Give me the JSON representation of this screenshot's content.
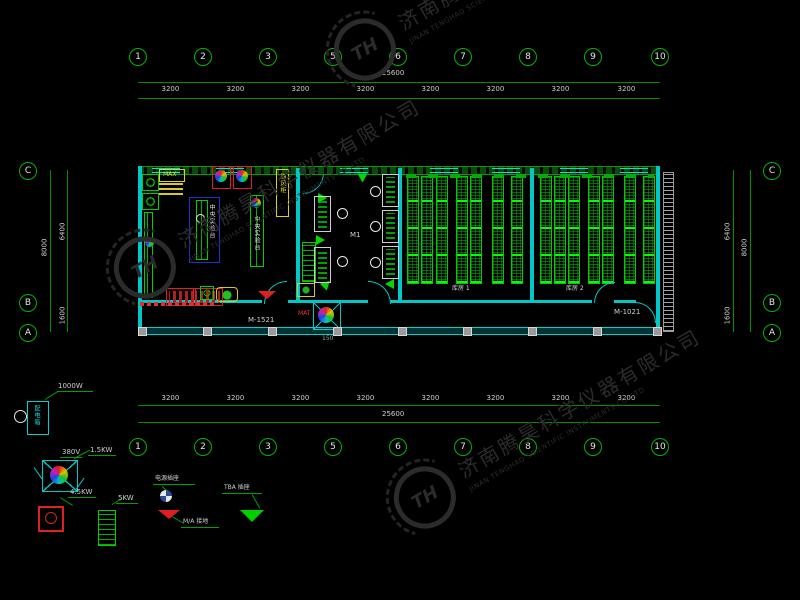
{
  "watermark": {
    "logo_text": "TH",
    "company_cn": "济南腾昊科学仪器有限公司",
    "company_en": "JINAN TENGHAO SCIENTIFIC INSTRUMENTS CO.,LTD"
  },
  "grid": {
    "column_bubbles": [
      "1",
      "2",
      "3",
      "5",
      "6",
      "7",
      "8",
      "9",
      "10"
    ],
    "row_bubbles": [
      "C",
      "B",
      "A"
    ],
    "column_dims": [
      "3200",
      "3200",
      "3200",
      "3200",
      "3200",
      "3200",
      "3200",
      "3200"
    ],
    "total_dim": "25600",
    "row_dims": {
      "total": "8000",
      "c_to_b": "6400",
      "b_to_a": "1600"
    }
  },
  "plan": {
    "door_tag_left": "M-1521",
    "door_tag_right": "M-1021",
    "room1_label": "库房 1",
    "room2_label": "库房 2",
    "bench_label": "中央实验台",
    "bench2_label": "中央实验台",
    "fume_label": "通风柜",
    "max_label": "MAX",
    "mat_label": "MAT",
    "hall_label": "M1",
    "small_dim": "150"
  },
  "legend": {
    "panel_text": "配电箱",
    "power_label": "1000W",
    "fan_voltage": "380V",
    "fan_power": "1.5KW",
    "socket_power": "4.5KW",
    "ladder_power": "5KW",
    "outlet_label": "电源插座",
    "ground_label": "M/A 接地",
    "tba_label": "TBA 插座"
  }
}
